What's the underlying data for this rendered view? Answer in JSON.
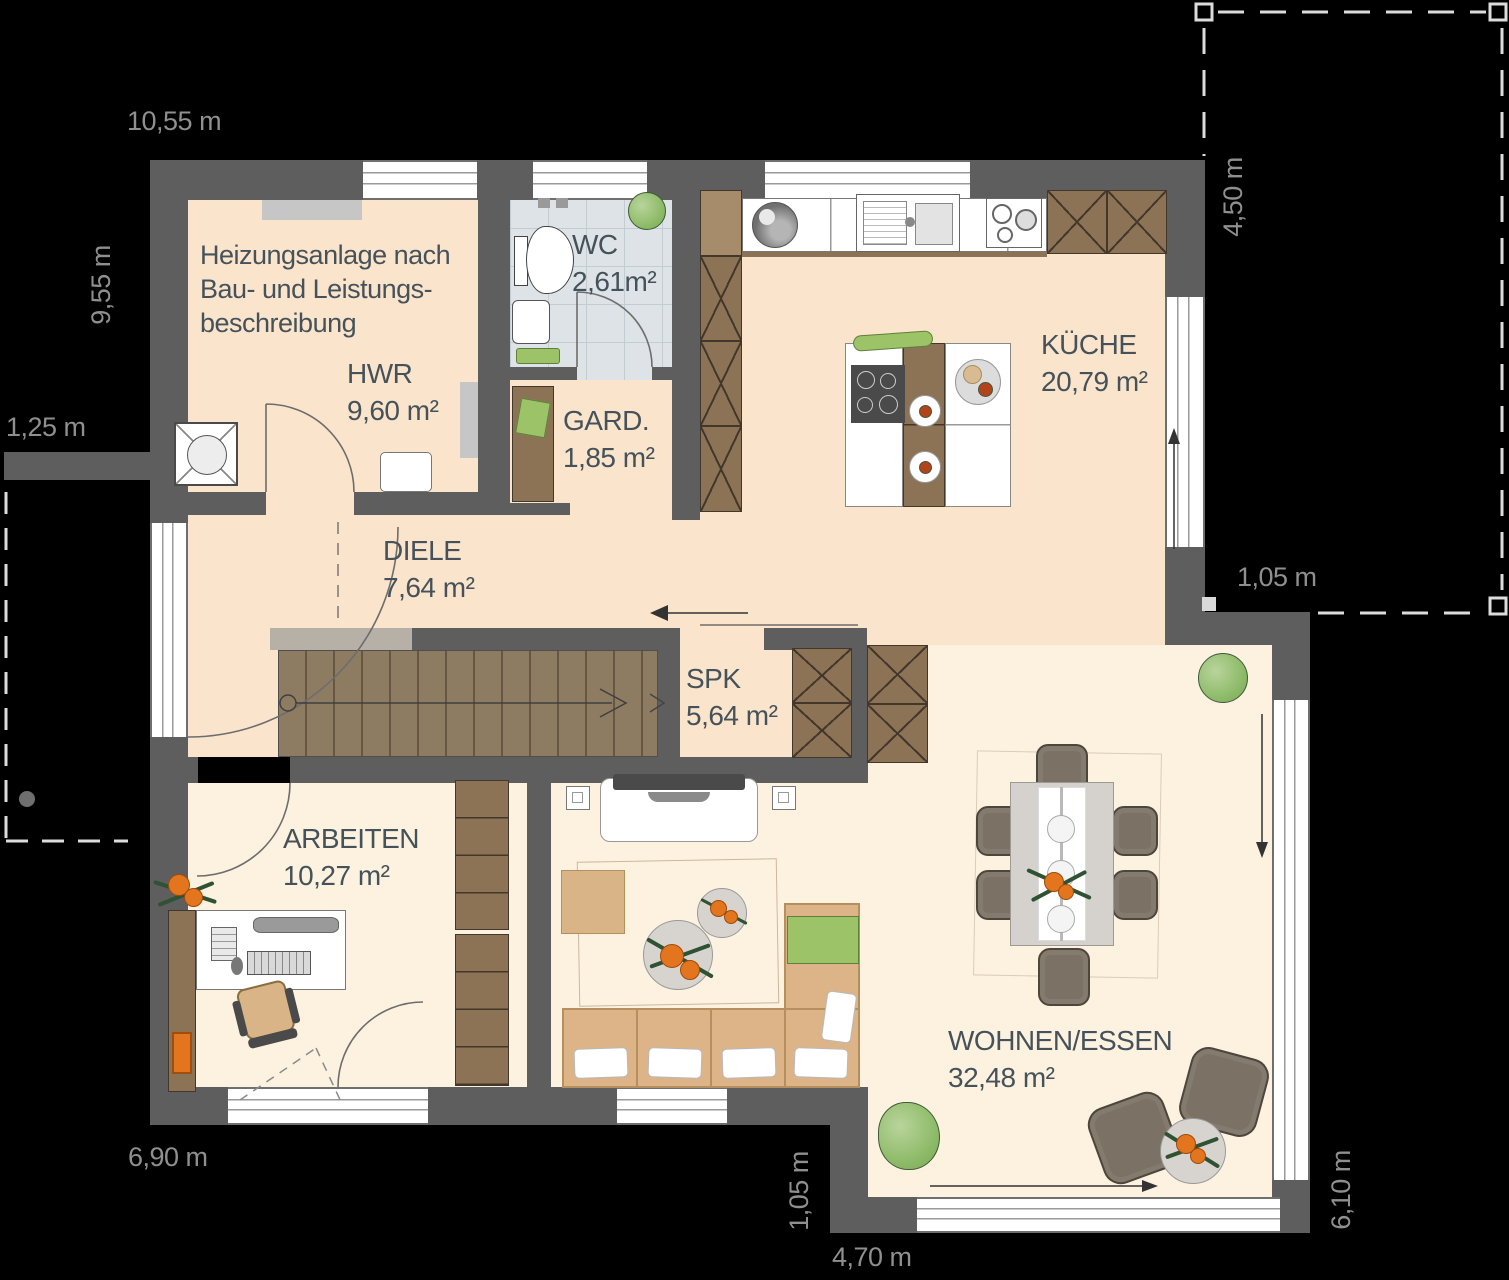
{
  "plan": {
    "note": [
      "Heizungsanlage nach",
      "Bau- und Leistungs-",
      "beschreibung"
    ],
    "rooms": {
      "hwr": {
        "name": "HWR",
        "area": "9,60 m²"
      },
      "wc": {
        "name": "WC",
        "area": "2,61m²"
      },
      "gard": {
        "name": "GARD.",
        "area": "1,85 m²"
      },
      "kueche": {
        "name": "KÜCHE",
        "area": "20,79 m²"
      },
      "diele": {
        "name": "DIELE",
        "area": "7,64 m²"
      },
      "spk": {
        "name": "SPK",
        "area": "5,64 m²"
      },
      "arbeiten": {
        "name": "ARBEITEN",
        "area": "10,27 m²"
      },
      "wohnen": {
        "name": "WOHNEN/ESSEN",
        "area": "32,48 m²"
      }
    },
    "dimensions": {
      "top": "10,55 m",
      "left": "9,55 m",
      "porch": "1,25 m",
      "right_upper": "4,50 m",
      "right_mid": "1,05 m",
      "bottom_left": "6,90 m",
      "bottom_mid": "1,05 m",
      "bottom_terrace": "4,70 m",
      "bottom_right": "6,10 m"
    },
    "colors": {
      "background": "#000000",
      "wall": "#5e5e5e",
      "floor_warm": "#fbe4cc",
      "floor_light": "#fdf2e0",
      "tile": "#dde3e6",
      "wood": "#8d7356",
      "stair": "#8e7c62",
      "accent_green": "#9cc368",
      "accent_orange": "#e2751d",
      "label_text": "#45525a",
      "dim_text": "#8f8f8f"
    }
  }
}
